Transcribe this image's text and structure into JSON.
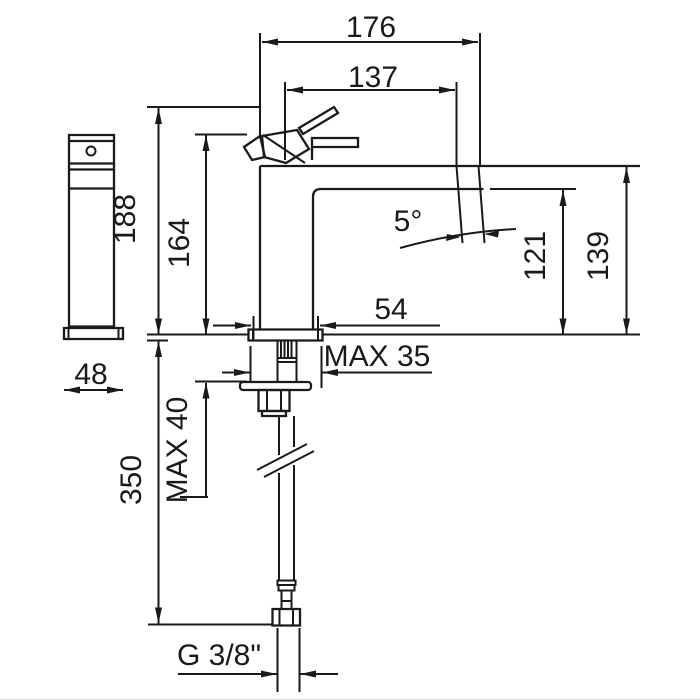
{
  "drawing": {
    "type": "technical-dimension-drawing",
    "subject": "single-lever basin mixer tap, side and front elevation with installation dimensions",
    "line_color": "#1a1a1a",
    "background_color": "#ffffff",
    "labels": {
      "d176": "176",
      "d137": "137",
      "d188": "188",
      "d164": "164",
      "d121": "121",
      "d139": "139",
      "d54": "54",
      "d48": "48",
      "d350": "350",
      "max35": "MAX 35",
      "max40": "MAX 40",
      "angle": "5°",
      "thread": "G 3/8\""
    }
  }
}
